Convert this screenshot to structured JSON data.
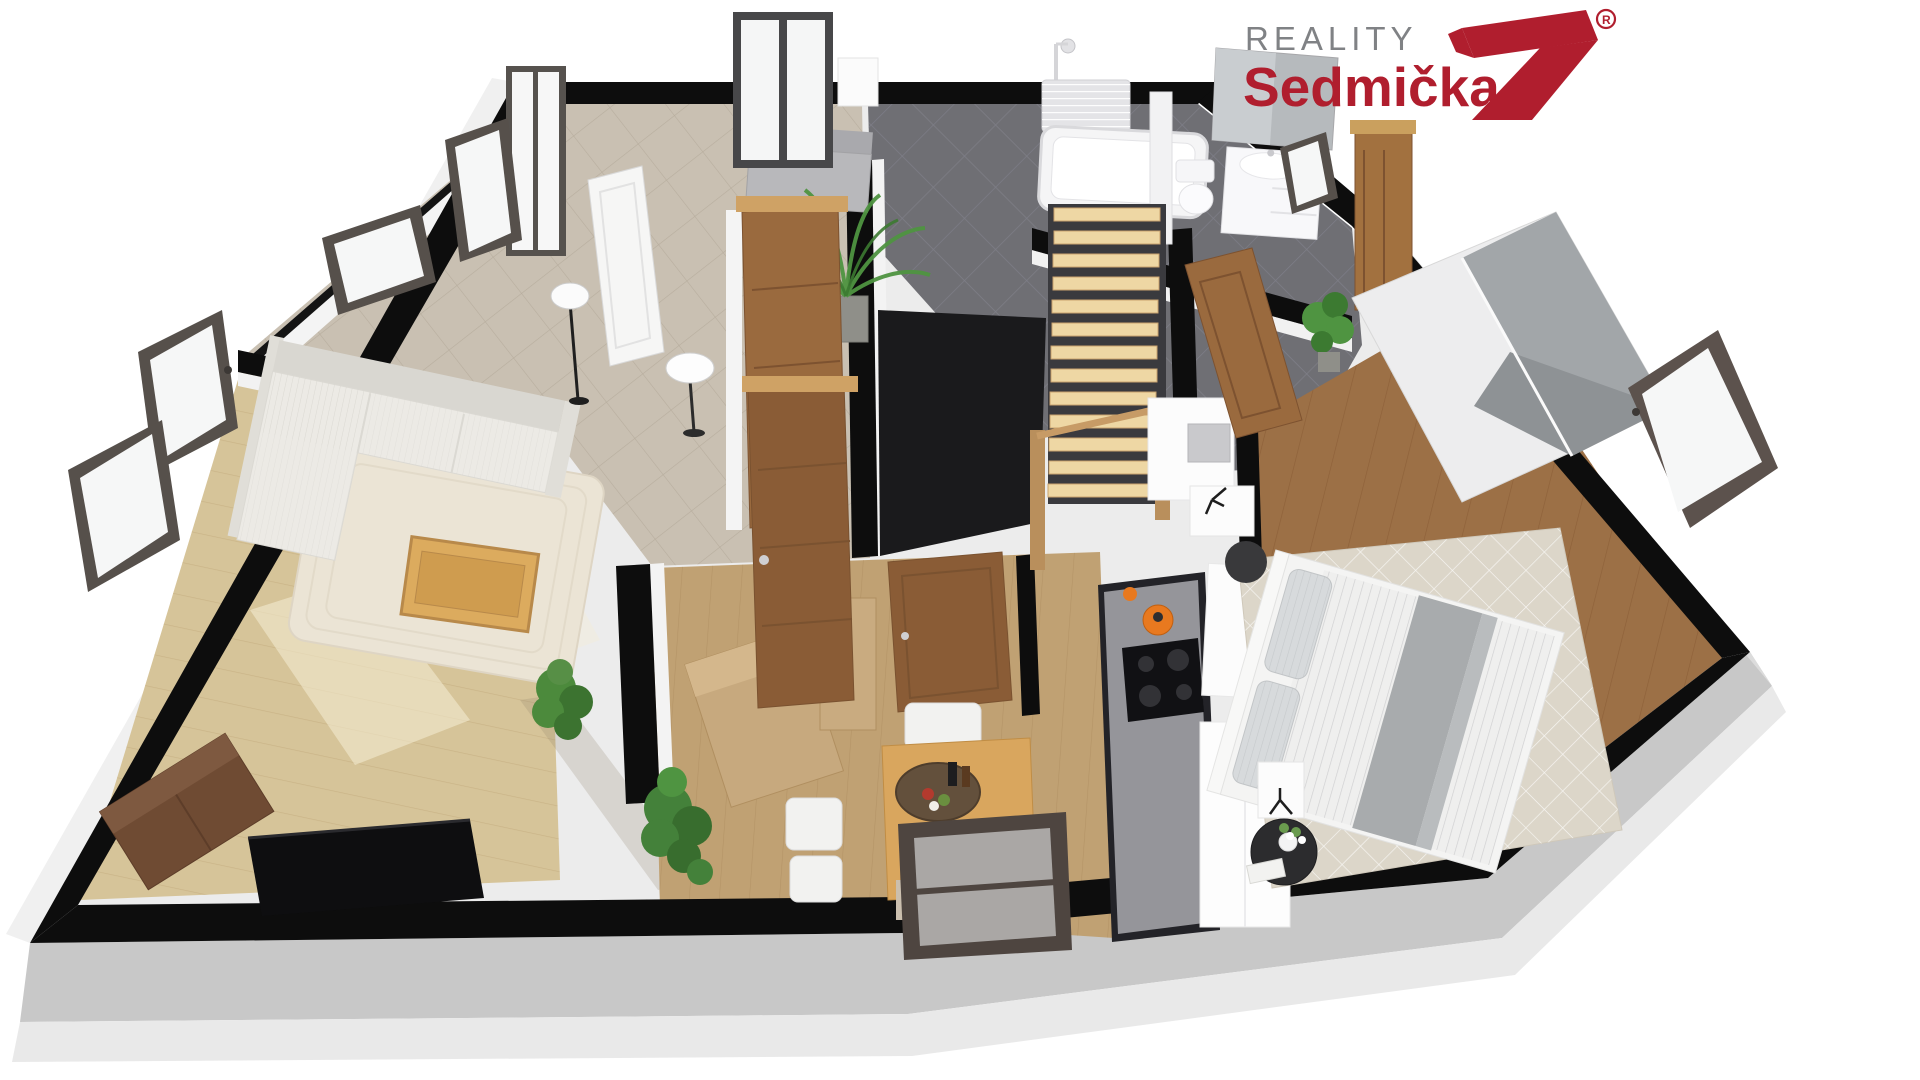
{
  "logo": {
    "line1": "REALITY",
    "line2": "Sedmička",
    "registered_mark": "R",
    "color_line1": "#808285",
    "color_line2": "#b01e2e",
    "color_mark": "#b01e2e"
  },
  "scene": {
    "type": "3d-floorplan-render",
    "background": "#ffffff",
    "palette": {
      "wall_cut": "#0d0d0d",
      "exterior_wall": "#c8c8c8",
      "interior_wall": "#f2f2f2",
      "living_floor": "#d6c499",
      "hall_tile": "#c9c0b2",
      "bath_tile": "#6f6f74",
      "dining_floor": "#c0a173",
      "bedroom_floor": "#9c7046",
      "door_wood": "#8a5c36",
      "stair_wood": "#eed7a4",
      "window_frame": "#4e4540",
      "accent_kettle": "#e8791f"
    },
    "rooms": [
      {
        "name": "living-room",
        "furniture": [
          "corner-sofa",
          "coffee-table",
          "area-rug",
          "tv",
          "sideboard",
          "floor-lamp",
          "plant"
        ]
      },
      {
        "name": "hallway",
        "furniture": [
          "bench",
          "palm-plant",
          "floor-lamp",
          "leaning-white-door",
          "shoe-cabinet"
        ]
      },
      {
        "name": "bathroom",
        "furniture": [
          "bathtub",
          "shower",
          "towel-radiator",
          "toilet",
          "vanity-sink",
          "mirror"
        ]
      },
      {
        "name": "staircase",
        "furniture": [
          "wood-treads",
          "newel-posts",
          "handrail"
        ]
      },
      {
        "name": "kitchen",
        "furniture": [
          "dark-counter",
          "gas-hob",
          "kettle",
          "fridge",
          "tall-white-units"
        ]
      },
      {
        "name": "bedroom",
        "furniture": [
          "double-bed",
          "pillows",
          "wardrobe-sliding-mirror",
          "nightstand",
          "round-side-table",
          "table-lamp",
          "diamond-rug",
          "plant",
          "leaning-door"
        ]
      },
      {
        "name": "dining-area",
        "furniture": [
          "dining-table",
          "white-chairs",
          "serving-tray",
          "wood-chest",
          "tall-wood-cabinet",
          "plant"
        ]
      }
    ],
    "openings": [
      "entry-glass-double-door",
      "interior-wood-doors",
      "tilted-open-windows"
    ]
  }
}
